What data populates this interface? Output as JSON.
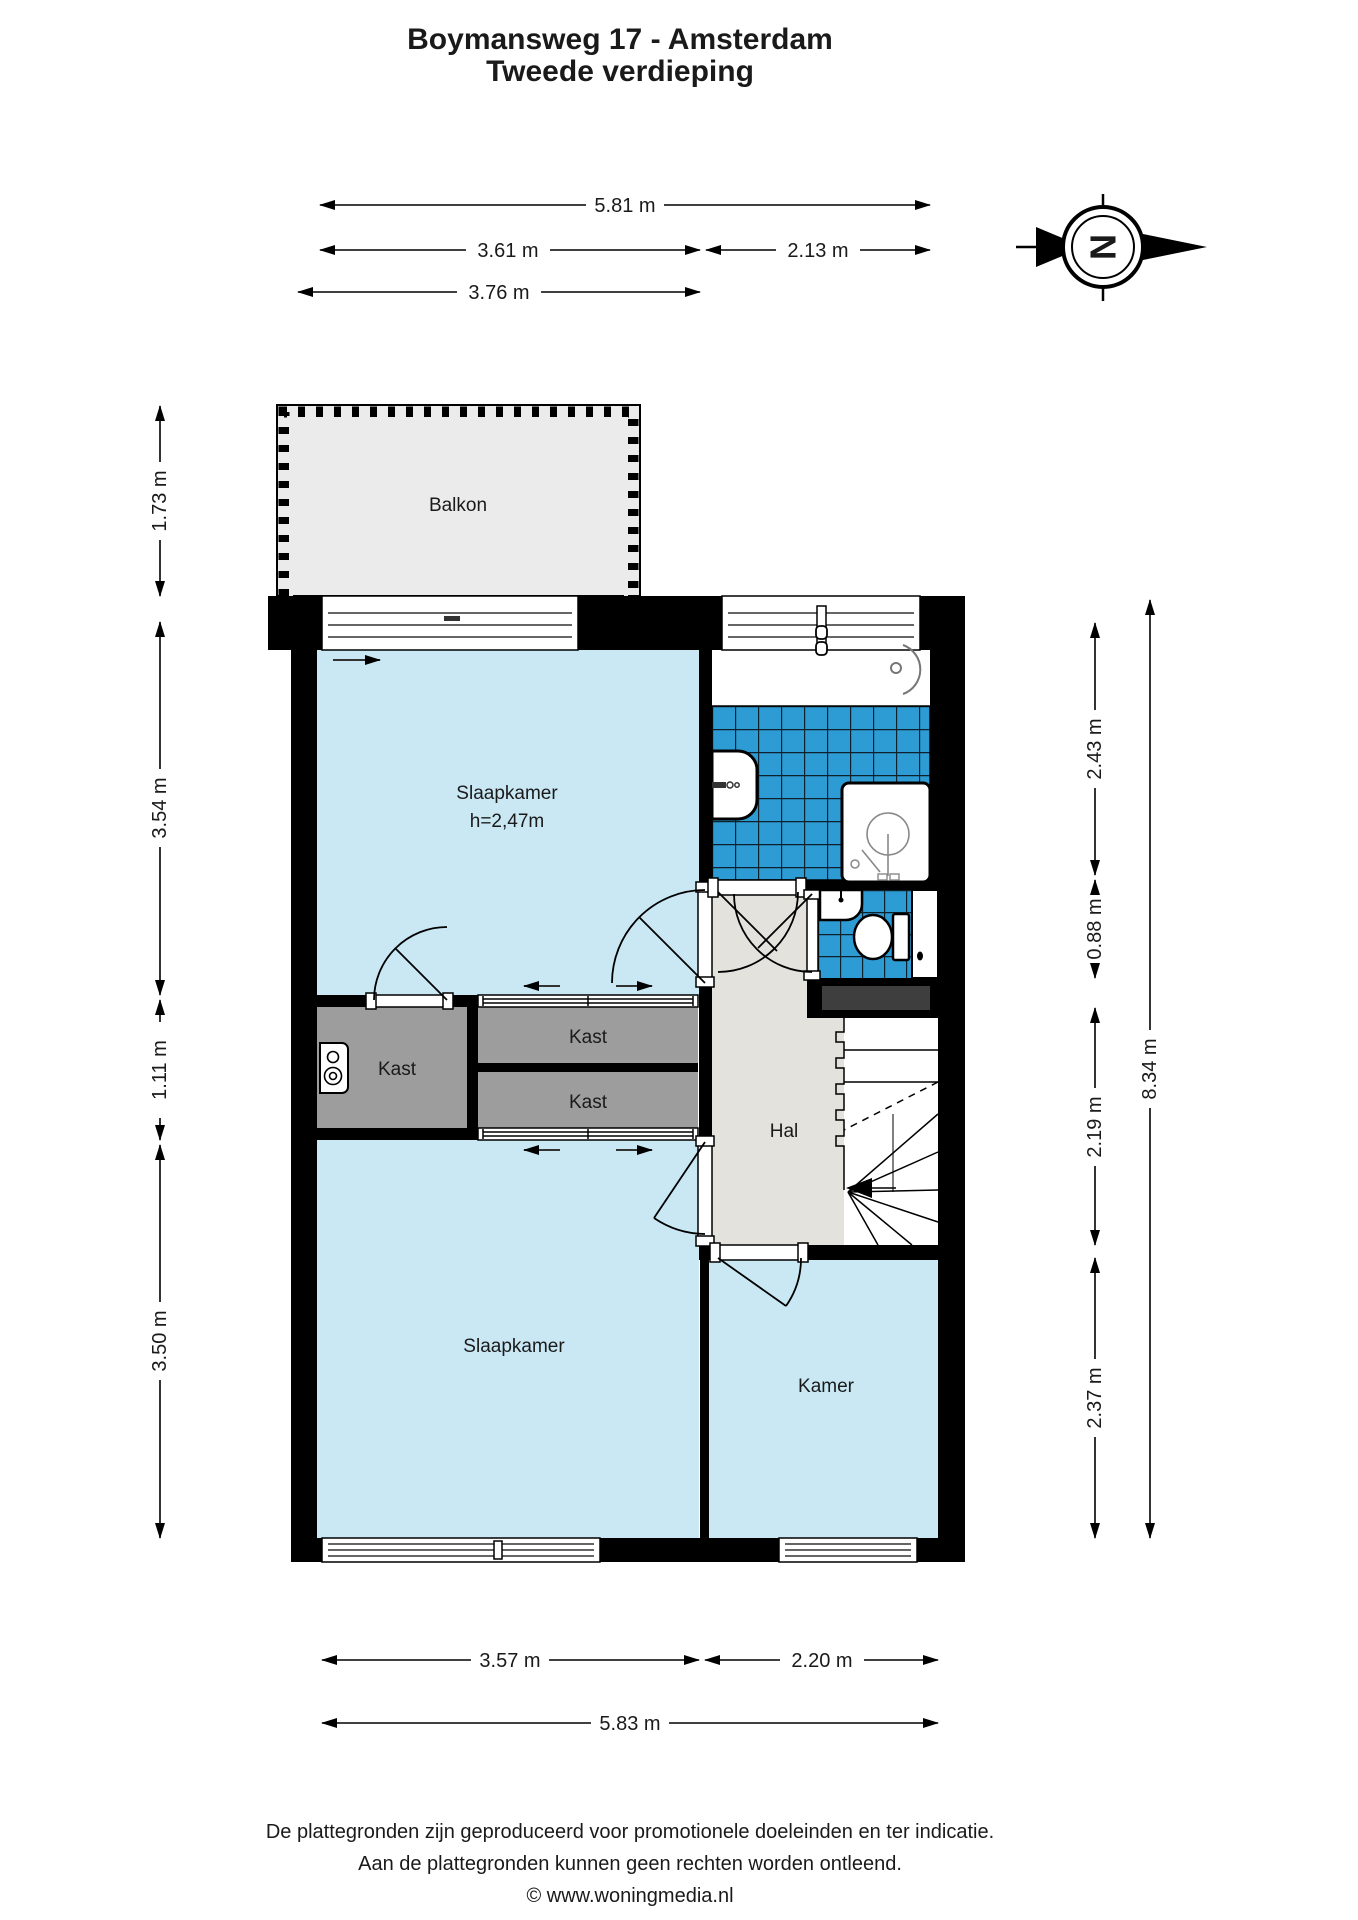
{
  "title": {
    "line1": "Boymansweg 17 - Amsterdam",
    "line2": "Tweede verdieping"
  },
  "compass": {
    "letter": "N"
  },
  "rooms": {
    "balkon": "Balkon",
    "slaapkamer_top": "Slaapkamer",
    "slaapkamer_top_height": "h=2,47m",
    "kast_left": "Kast",
    "kast_top": "Kast",
    "kast_bottom": "Kast",
    "hal": "Hal",
    "slaapkamer_bottom": "Slaapkamer",
    "kamer": "Kamer"
  },
  "dims": {
    "top_full": "5.81 m",
    "top_left": "3.61 m",
    "top_right": "2.13 m",
    "top_balcony": "3.76 m",
    "left_balcony": "1.73 m",
    "left_bedroom_top": "3.54 m",
    "left_closet": "1.11 m",
    "left_bedroom_bottom": "3.50 m",
    "right_bathroom": "2.43 m",
    "right_toilet": "0.88 m",
    "right_hall": "2.19 m",
    "right_room": "2.37 m",
    "right_full": "8.34 m",
    "bottom_left": "3.57 m",
    "bottom_right": "2.20 m",
    "bottom_full": "5.83 m"
  },
  "footer": {
    "line1": "De plattegronden zijn geproduceerd voor promotionele doeleinden en ter indicatie.",
    "line2": "Aan de plattegronden kunnen geen rechten worden ontleend.",
    "line3": "© www.woningmedia.nl"
  },
  "colors": {
    "room_blue": "#C9E8F4",
    "tile_blue": "#2E9CD4",
    "tile_grid": "#0E212C",
    "closet_gray": "#9D9D9D",
    "hall_gray": "#E3E2DD",
    "balcony_gray": "#EBEBEB",
    "shaft_gray": "#3E3E3E",
    "wall_black": "#000000"
  }
}
